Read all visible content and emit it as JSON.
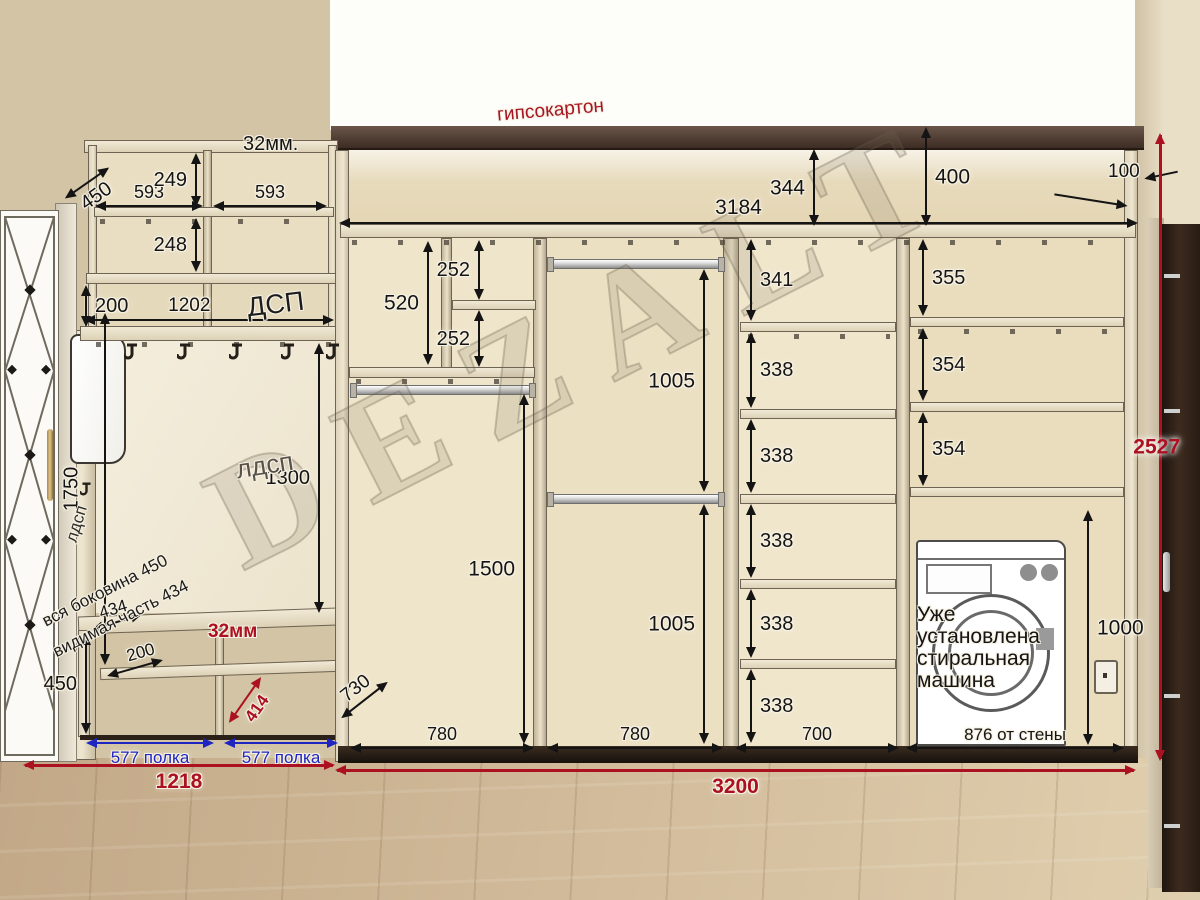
{
  "colors": {
    "dim_black": "#141414",
    "dim_red": "#ab1120",
    "dim_blue": "#1f25c0",
    "red_text": "#a51523",
    "drywall_strip": "#46352b",
    "wall_tan": "#d2c4a5",
    "floor_wood": "#c9b18f"
  },
  "watermark": "DEZALT",
  "notes": {
    "drywall": "гипсокартон",
    "washer": "Уже установлена стиральная машина",
    "side1": "вся боковина 450",
    "side2": "видимая часть 434"
  },
  "hall": {
    "top_gap": "32мм.",
    "depth": "450",
    "cab_w_l": "593",
    "cab_w_r": "593",
    "row1": "249",
    "row2": "248",
    "gap": "200",
    "shelf_len": "1202",
    "shelf_mat": "ДСП",
    "side_mat": "лдсп",
    "panel_mat": "лдсп",
    "panel_h": "1300",
    "door_h": "1750",
    "bench_depth": "434",
    "bench_shelf": "200",
    "bench_h": "450",
    "bench_div": "32мм",
    "bench_diag": "414",
    "shelf_l": "577 полка",
    "shelf_r": "577 полка",
    "width": "1218"
  },
  "ward": {
    "top_l": "344",
    "top_r": "400",
    "inner_w": "3184",
    "gap_r": "100",
    "c1_up": "520",
    "c1_s1": "252",
    "c1_s2": "252",
    "c1_low": "1500",
    "c2_up": "1005",
    "c2_low": "1005",
    "c3_r1": "341",
    "c3_r2": "338",
    "c3_r3": "338",
    "c3_r4": "338",
    "c3_r5": "338",
    "c3_r6": "338",
    "c4_r1": "355",
    "c4_r2": "354",
    "c4_r3": "354",
    "c4_wash": "1000",
    "c4_w": "876 от стены",
    "c1_w": "780",
    "c2_w": "780",
    "c3_w": "700",
    "depth": "730",
    "width": "3200",
    "height": "2527"
  }
}
